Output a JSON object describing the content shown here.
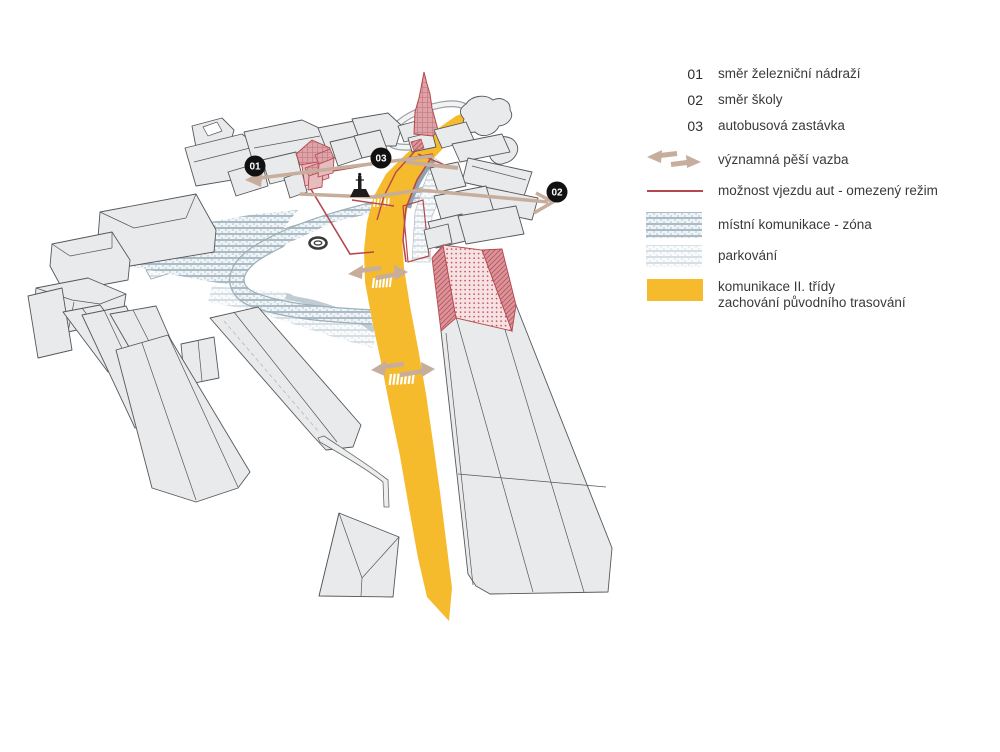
{
  "legend": {
    "items": [
      {
        "key": "01",
        "label": "směr železniční nádraží"
      },
      {
        "key": "02",
        "label": "směr školy"
      },
      {
        "key": "03",
        "label": "autobusová zastávka"
      },
      {
        "icon": "pedestrian-link-arrows",
        "label": "významná pěší vazba"
      },
      {
        "icon": "restricted-car-access-line",
        "label": "možnost vjezdu aut - omezený režim"
      },
      {
        "icon": "local-road-zone-hatch",
        "label": "místní komunikace - zóna"
      },
      {
        "icon": "parking-hatch",
        "label": "parkování"
      },
      {
        "icon": "class-2-road-fill",
        "label": "komunikace II. třídy",
        "label2": "zachování původního trasování"
      }
    ]
  },
  "map": {
    "badges": [
      {
        "label": "01"
      },
      {
        "label": "02"
      },
      {
        "label": "03"
      }
    ]
  },
  "colors": {
    "road_yellow": "#F6BA2D",
    "pedestrian_tan": "#C7AD9C",
    "restricted_red": "#B5484E",
    "zone_hatch_line": "#A9BCC6",
    "parking_hatch_line": "#D6DFE4",
    "building_fill": "#E9EAEB",
    "building_stroke": "#55585B",
    "badge_black": "#111111"
  }
}
